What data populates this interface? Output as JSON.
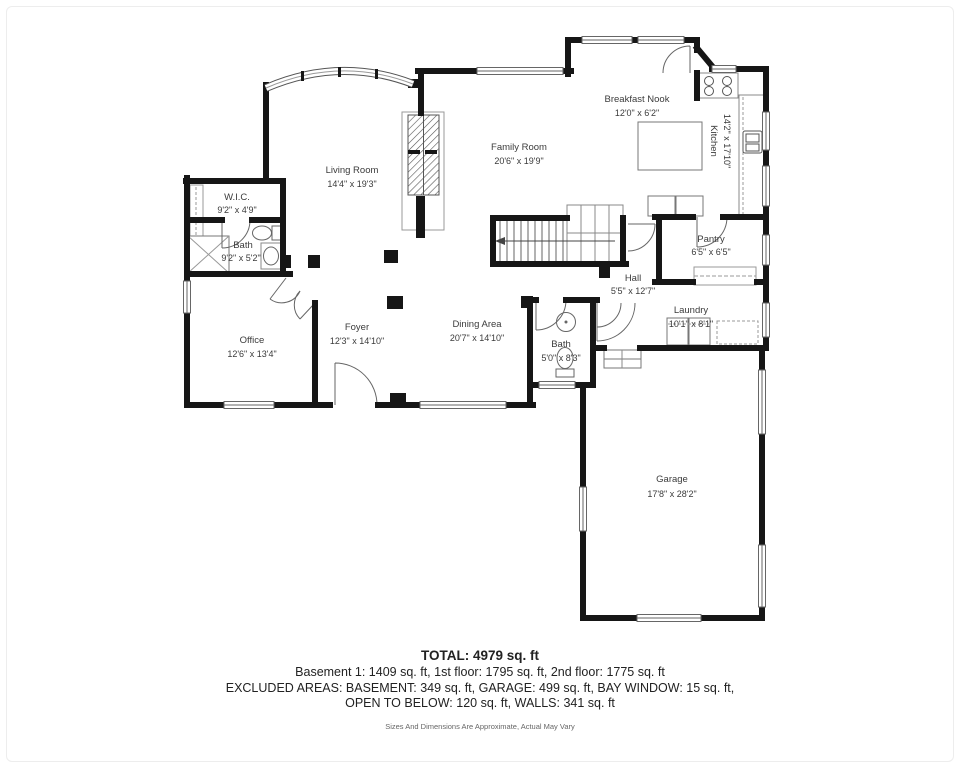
{
  "plan": {
    "title": "First floor plan",
    "rooms": [
      {
        "name": "Breakfast Nook",
        "dims": "12'0\" x 6'2\""
      },
      {
        "name": "Kitchen",
        "dims": "14'2\" x 17'10\""
      },
      {
        "name": "Family Room",
        "dims": "20'6\" x 19'9\""
      },
      {
        "name": "Living Room",
        "dims": "14'4\" x 19'3\""
      },
      {
        "name": "W.I.C.",
        "dims": "9'2\" x 4'9\""
      },
      {
        "name": "Bath",
        "dims": "9'2\" x 5'2\""
      },
      {
        "name": "Office",
        "dims": "12'6\" x 13'4\""
      },
      {
        "name": "Foyer",
        "dims": "12'3\" x 14'10\""
      },
      {
        "name": "Dining Area",
        "dims": "20'7\" x 14'10\""
      },
      {
        "name": "Hall",
        "dims": "5'5\" x 12'7\""
      },
      {
        "name": "Pantry",
        "dims": "6'5\" x 6'5\""
      },
      {
        "name": "Laundry",
        "dims": "10'1\" x 8'1\""
      },
      {
        "name": "Bath",
        "dims": "5'0\" x 8'3\""
      },
      {
        "name": "Garage",
        "dims": "17'8\" x 28'2\""
      }
    ],
    "colors": {
      "wall": "#161616",
      "fixture_line": "#777777",
      "window_line": "#666666",
      "label_text": "#3b3b3b"
    }
  },
  "summary": {
    "total": "TOTAL: 4979 sq. ft",
    "floors": "Basement 1: 1409 sq. ft, 1st floor: 1795 sq. ft, 2nd floor: 1775 sq. ft",
    "excluded_line1": "EXCLUDED AREAS: BASEMENT: 349 sq. ft, GARAGE: 499 sq. ft, BAY WINDOW: 15 sq. ft,",
    "excluded_line2": "OPEN TO BELOW: 120 sq. ft, WALLS: 341 sq. ft",
    "disclaimer": "Sizes And Dimensions Are Approximate, Actual May Vary"
  }
}
